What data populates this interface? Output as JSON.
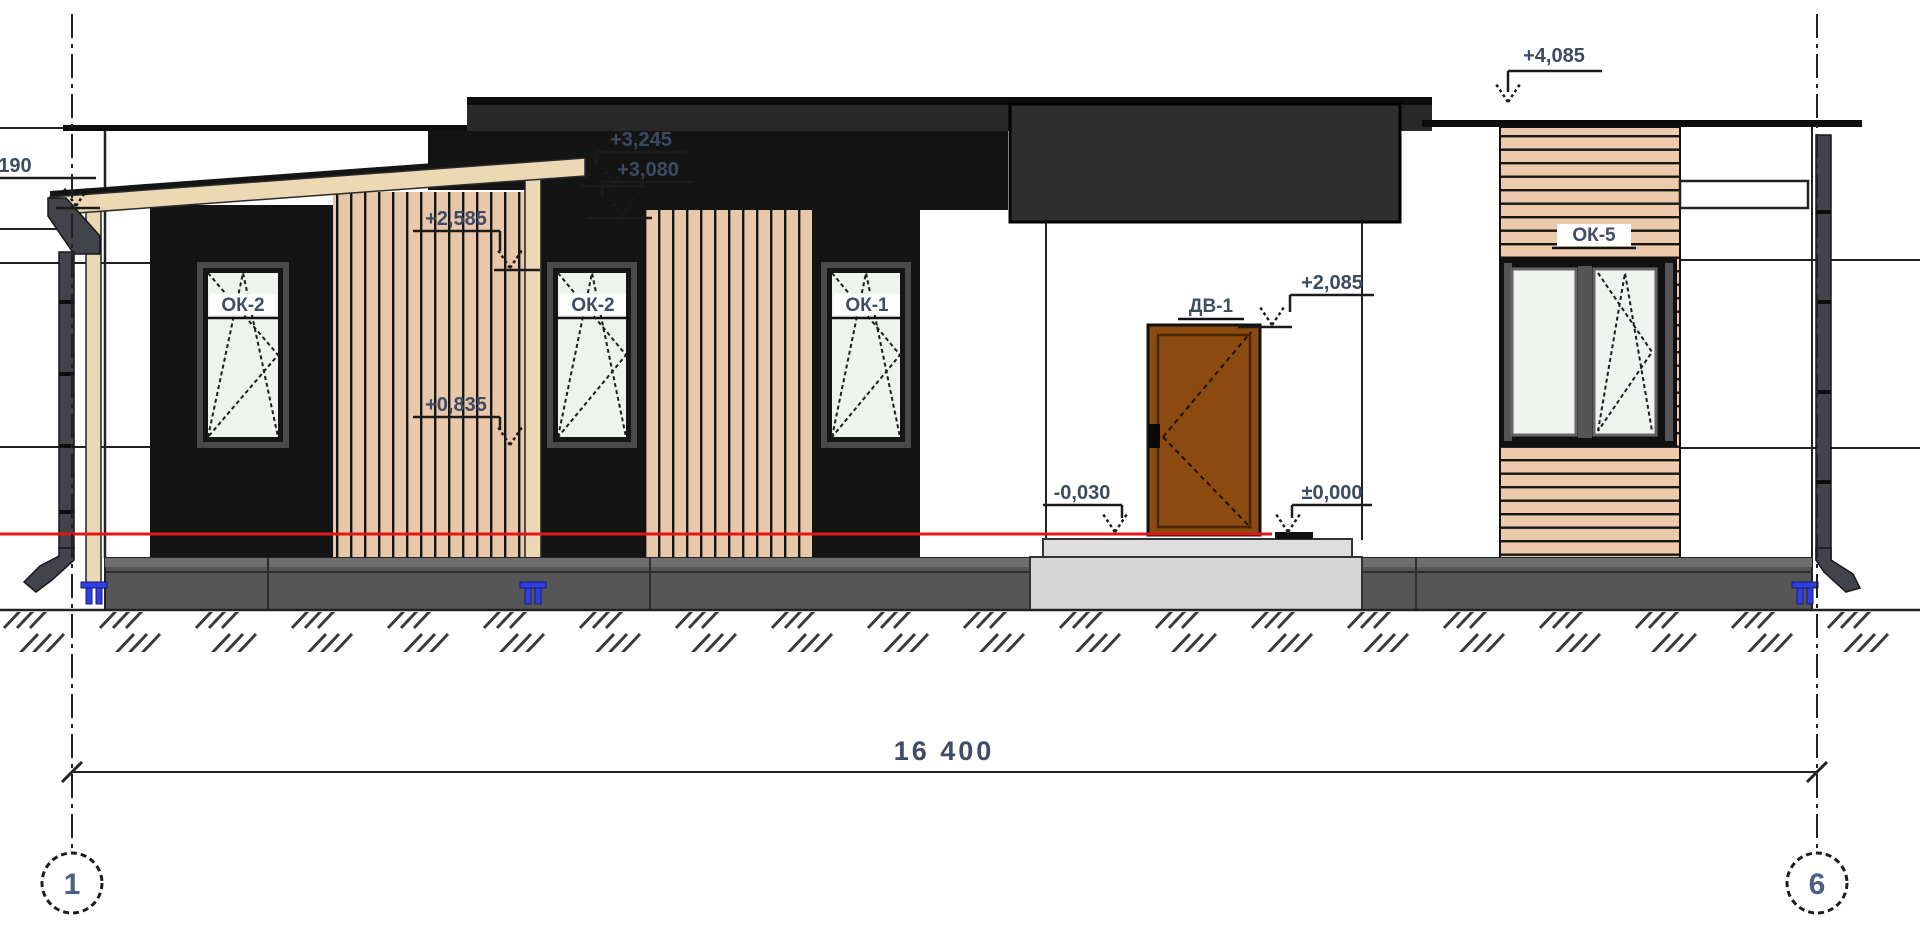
{
  "annotations": {
    "levels": {
      "roof": "+4,085",
      "left_cut": "190",
      "fascia_top": "+3,245",
      "fascia_bottom": "+3,080",
      "canopy": "+2,585",
      "sill": "+0,835",
      "door_top": "+2,085",
      "porch": "-0,030",
      "floor": "±0,000"
    },
    "openings": {
      "window_left": "ОК-2",
      "window_mid": "ОК-2",
      "window_right": "ОК-1",
      "door": "ДВ-1",
      "window_east": "ОК-5"
    },
    "dimension_total": "16 400",
    "axes": {
      "left": "1",
      "right": "6"
    },
    "colors": {
      "ground_level_line": "#e31616",
      "anchor_blue": "#2f3fe0",
      "wood": "#ecd9b4",
      "slat": "#e9c8aa",
      "wall_dark": "#141414"
    }
  }
}
